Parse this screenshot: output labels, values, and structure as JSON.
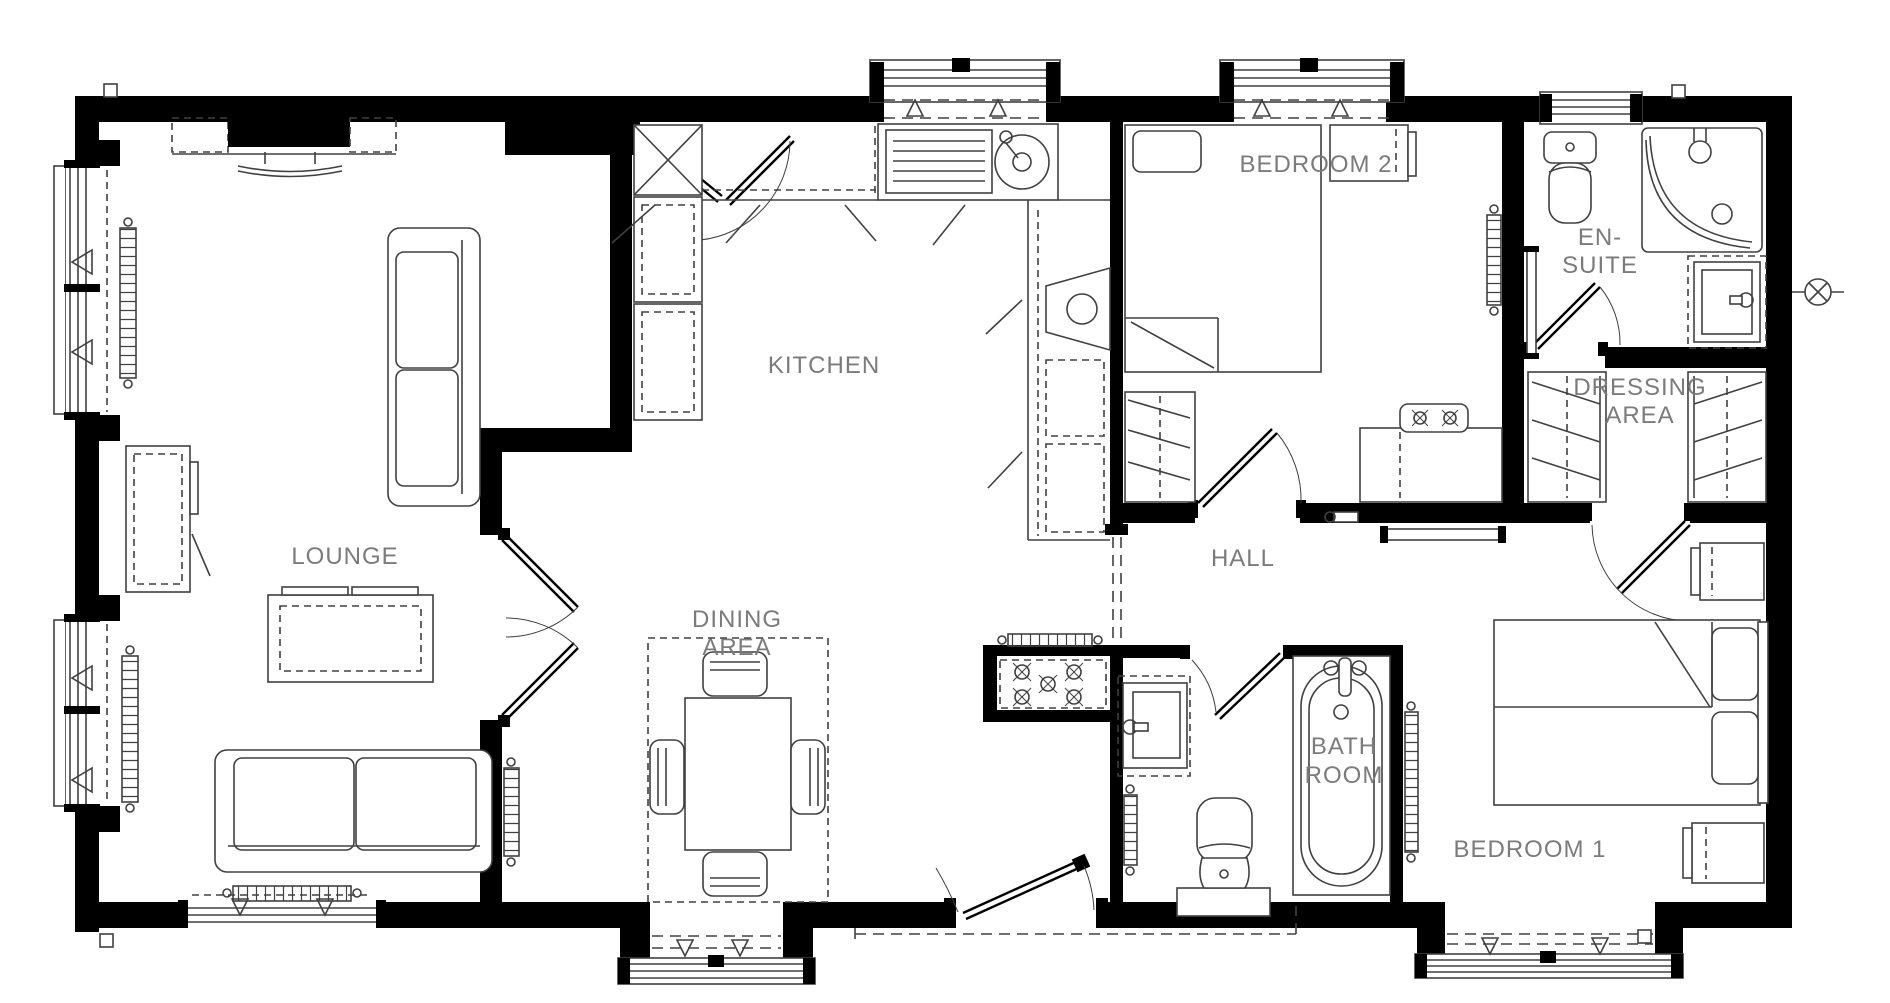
{
  "plan": {
    "title": "2-bedroom park home floor plan",
    "rooms": {
      "lounge": {
        "label": "LOUNGE"
      },
      "kitchen": {
        "label": "KITCHEN"
      },
      "dining": {
        "line1": "DINING",
        "line2": "AREA"
      },
      "bedroom2": {
        "label": "BEDROOM 2"
      },
      "ensuite": {
        "line1": "EN-",
        "line2": "SUITE"
      },
      "dressing": {
        "line1": "DRESSING",
        "line2": "AREA"
      },
      "hall": {
        "label": "HALL"
      },
      "bathroom": {
        "line1": "BATH",
        "line2": "ROOM"
      },
      "bedroom1": {
        "label": "BEDROOM 1"
      }
    },
    "colors": {
      "wall": "#000000",
      "line": "#404040",
      "label": "#7b7b7b",
      "background": "#ffffff"
    }
  }
}
